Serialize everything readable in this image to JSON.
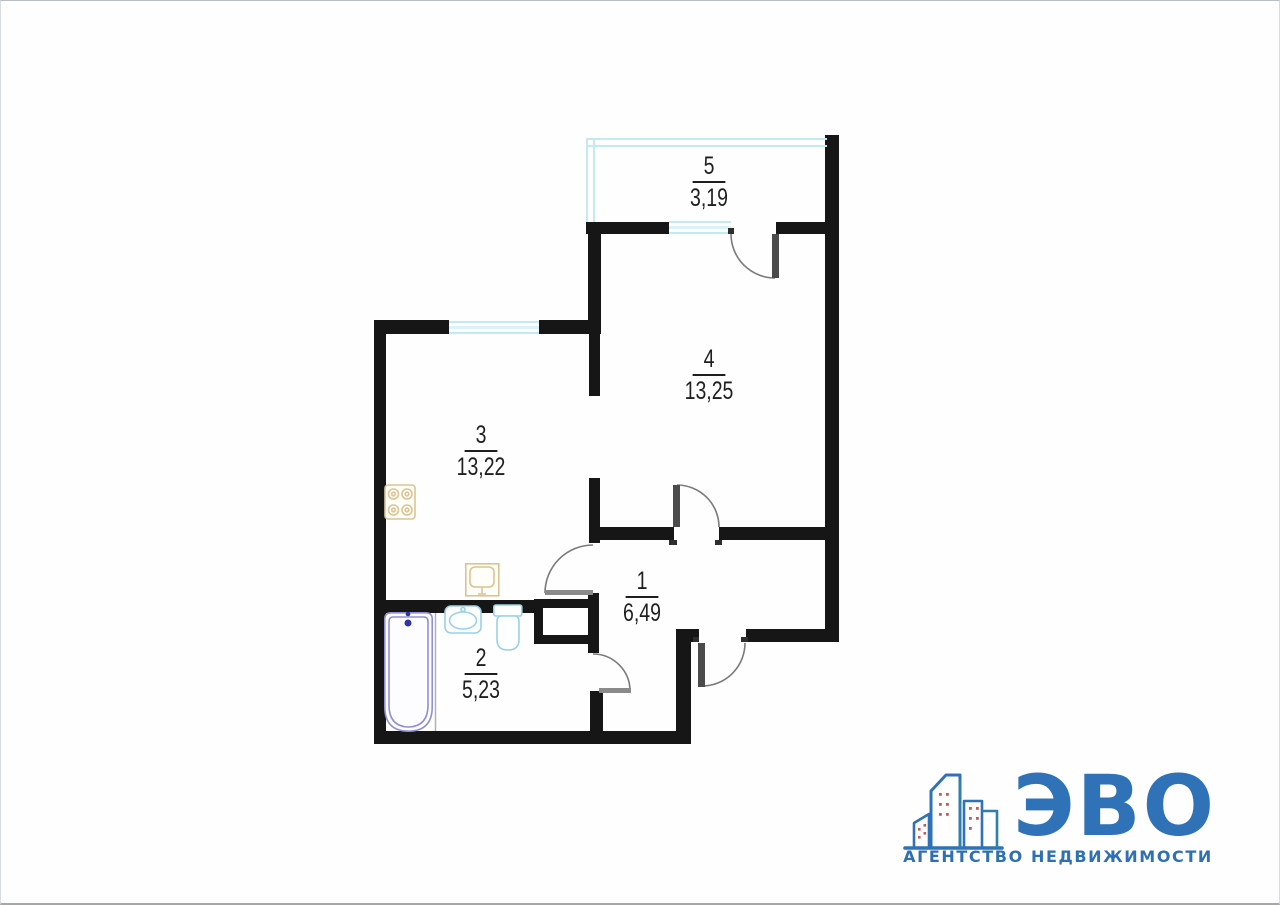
{
  "document": {
    "type": "apartment-floor-plan"
  },
  "rooms": [
    {
      "number": "1",
      "area": "6,49"
    },
    {
      "number": "2",
      "area": "5,23"
    },
    {
      "number": "3",
      "area": "13,22"
    },
    {
      "number": "4",
      "area": "13,25"
    },
    {
      "number": "5",
      "area": "3,19"
    }
  ],
  "plan": {
    "wall_color": "#161616",
    "glazing_color": "#c3e9f3",
    "door_arc_color": "#7a7a7a",
    "fixtures": [
      "bathtub",
      "washbasin",
      "toilet",
      "stove",
      "kitchen-sink",
      "ventilation-shaft"
    ],
    "fixture_colors": {
      "kitchen_appliances": "#dcc393",
      "bathroom_ceramics": "#9cd0e6",
      "bathtub_outline": "#9191d1",
      "taps": "#2c35a8"
    }
  },
  "logo": {
    "name": "ЭВО",
    "tagline": "АГЕНТСТВО НЕДВИЖИМОСТИ",
    "brand_color": "#2f72b7",
    "accent_color": "#2f7fa8",
    "window_dot_color": "#c25b5b"
  },
  "icons": {
    "building-skyline-icon": "outlined city buildings with red window dots above a baseline"
  }
}
